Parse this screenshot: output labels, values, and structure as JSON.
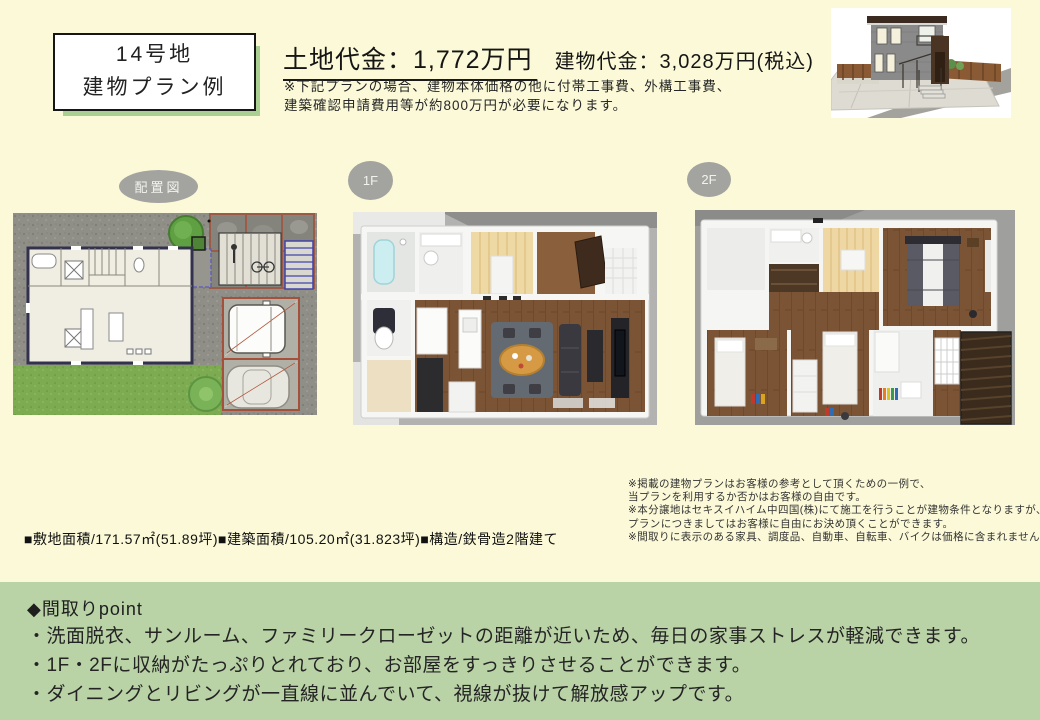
{
  "colors": {
    "page_bg": "#fbf9d7",
    "band_green": "#b9d2a6",
    "title_shadow_green": "#a9cf93",
    "plan_label_gray": "#a3a3a0"
  },
  "title_box": {
    "line1": "14号地",
    "line2": "建物プラン例"
  },
  "pricing": {
    "land_price": "土地代金：1,772万円",
    "building_price": "建物代金：3,028万円(税込)",
    "note_line1": "※下記プランの場合、建物本体価格の他に付帯工事費、外構工事費、",
    "note_line2": "建築確認申請費用等が約800万円が必要になります。"
  },
  "plan_labels": {
    "site": "配置図",
    "floor1": "1F",
    "floor2": "2F"
  },
  "specs_line": "■敷地面積/171.57㎡(51.89坪)■建築面積/105.20㎡(31.823坪)■構造/鉄骨造2階建て",
  "disclaimer": {
    "lines": [
      "※掲載の建物プランはお客様の参考として頂くための一例で、",
      "当プランを利用するか否かはお客様の自由です。",
      "※本分譲地はセキスイハイム中四国(株)にて施工を行うことが建物条件となりますが、",
      "プランにつきましてはお客様に自由にお決め頂くことができます。",
      "※間取りに表示のある家具、調度品、自動車、自転車、バイクは価格に含まれません"
    ]
  },
  "points": {
    "heading": "◆間取りpoint",
    "items": [
      "・洗面脱衣、サンルーム、ファミリークローゼットの距離が近いため、毎日の家事ストレスが軽減できます。",
      "・1F・2Fに収納がたっぷりとれており、お部屋をすっきりさせることができます。",
      "・ダイニングとリビングが一直線に並んでいて、視線が抜けて解放感アップです。"
    ]
  }
}
